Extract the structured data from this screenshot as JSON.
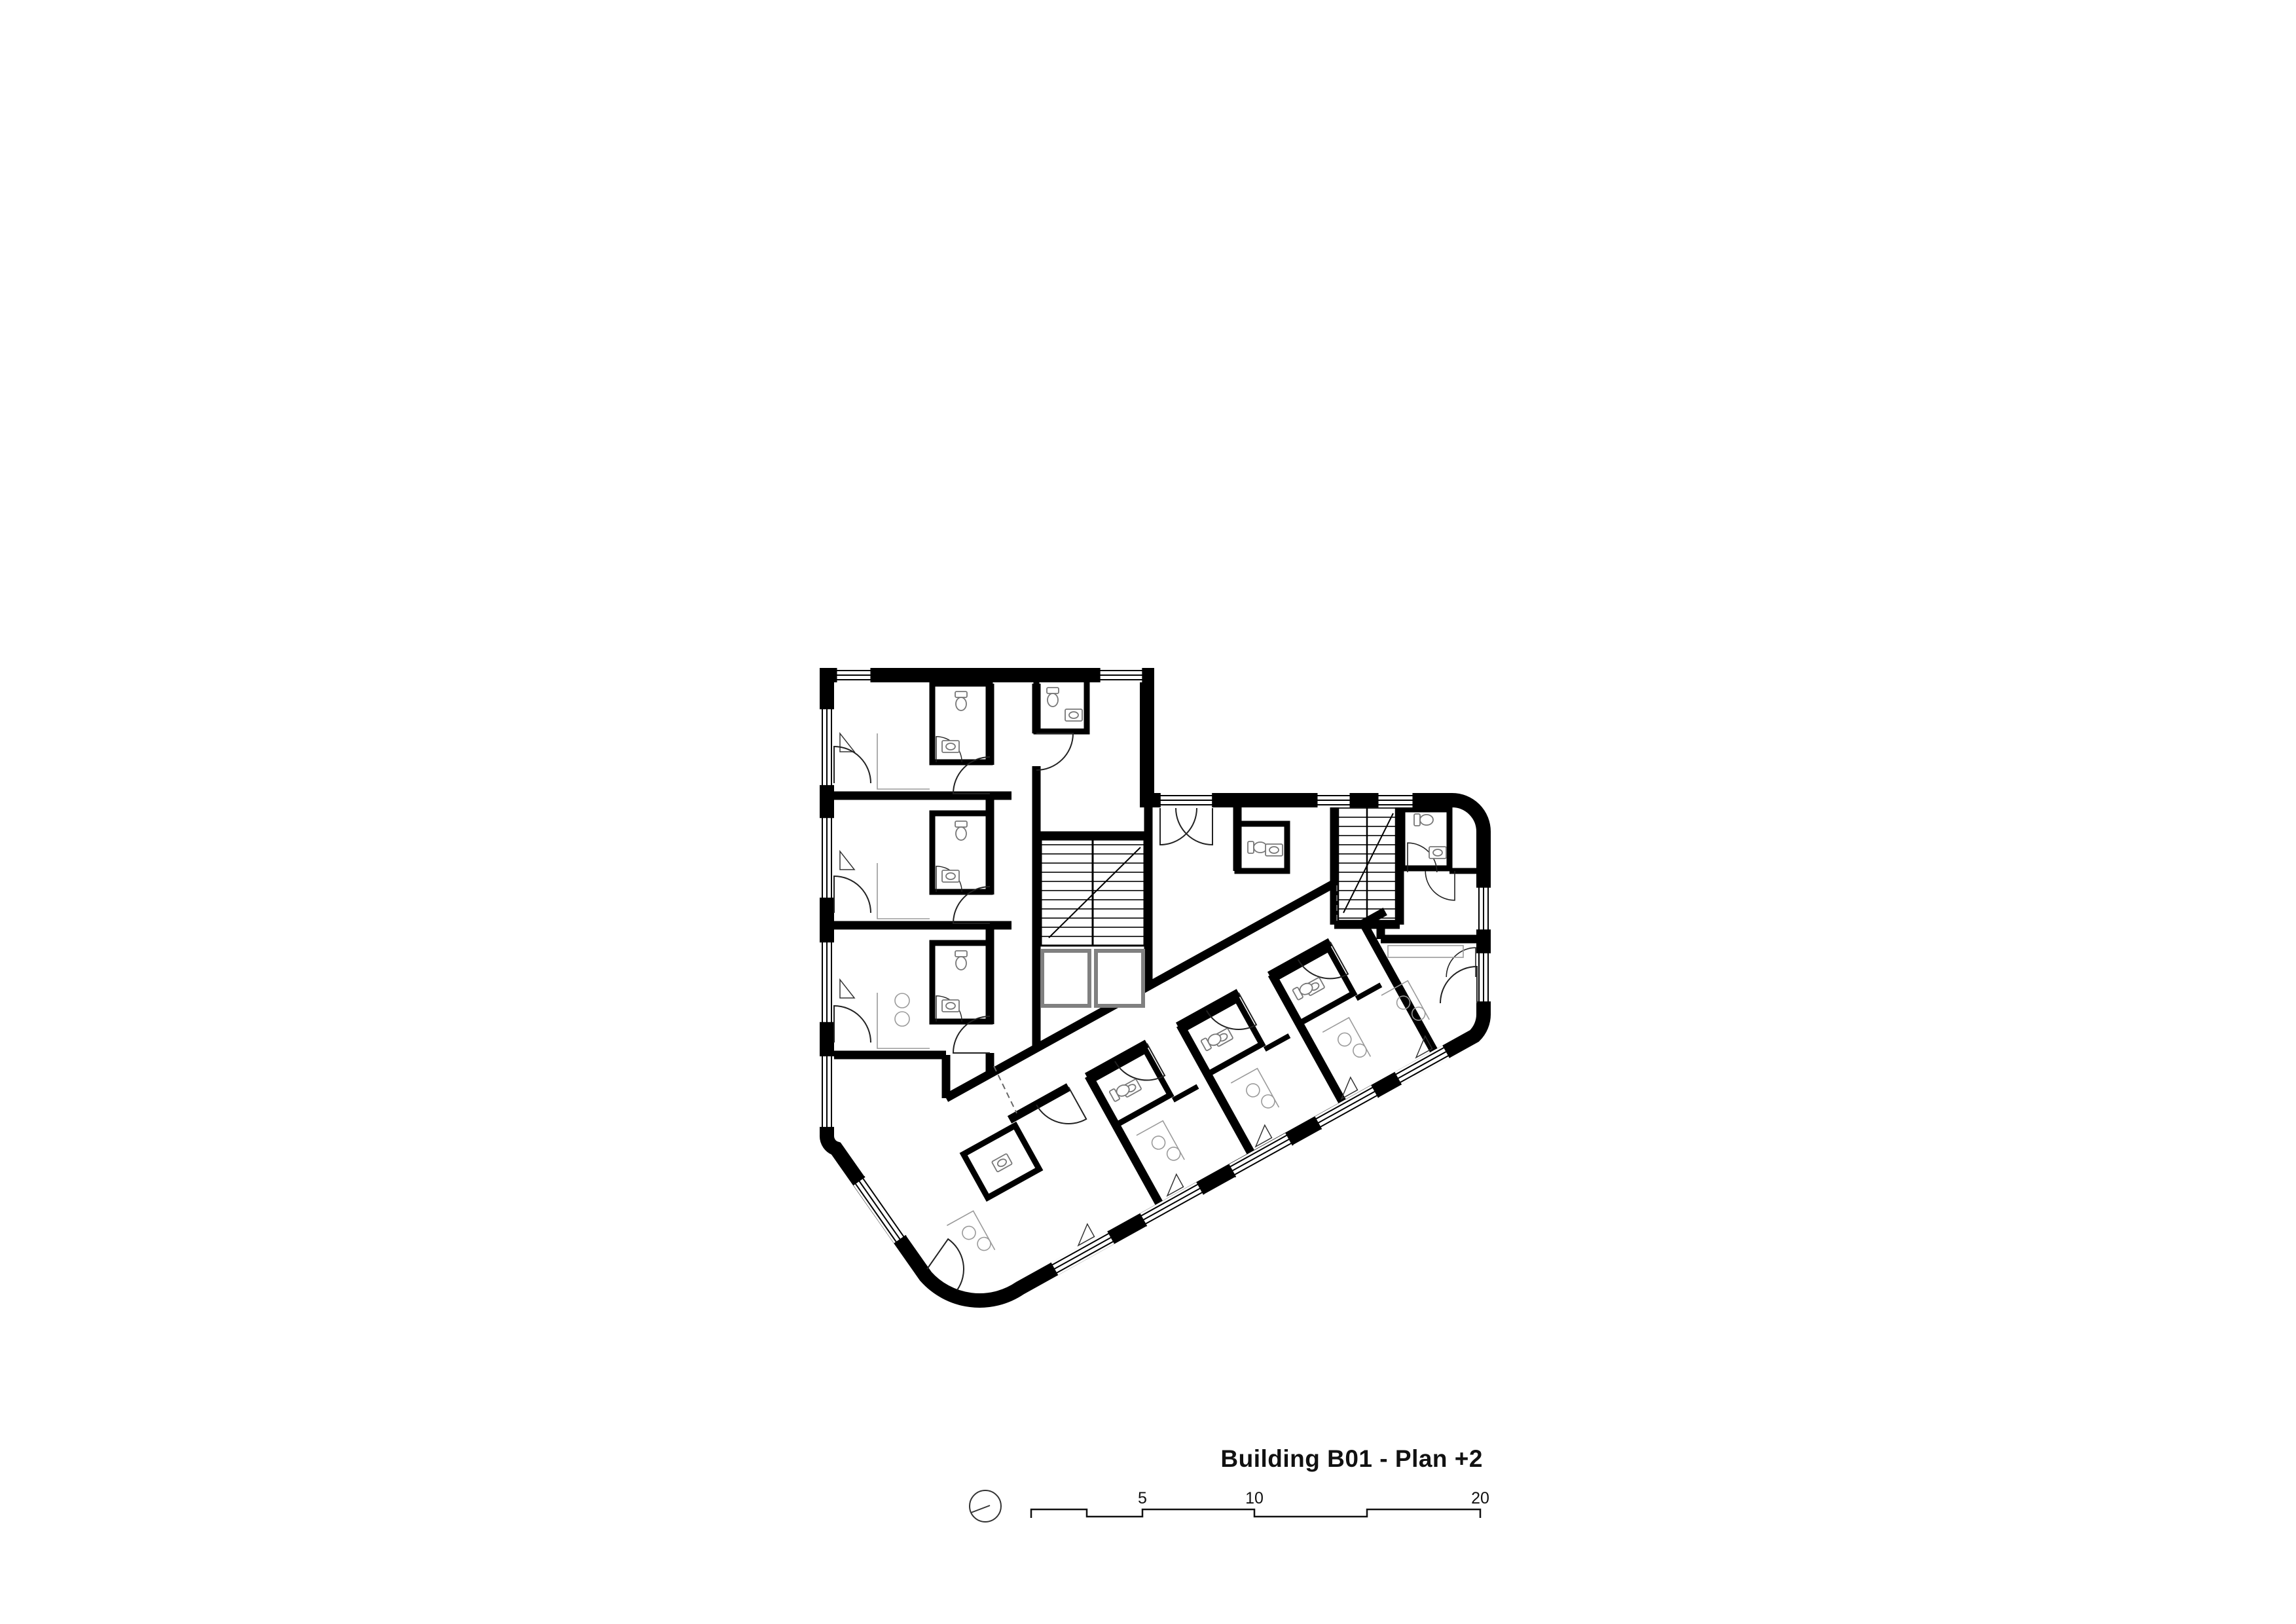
{
  "title_block": {
    "title": "Building B01 - Plan +2"
  },
  "scale_bar": {
    "unit_labels": {
      "five": "5",
      "ten": "10",
      "twenty": "20"
    }
  },
  "drawing": {
    "wall_color": "#000000",
    "line_color": "#1a1a1a",
    "furniture_color": "#9a9a9a",
    "shaft_color": "#808080",
    "dash_color": "#666666",
    "background": "#ffffff",
    "icons": {
      "north_indicator": "circle-with-needle"
    },
    "elements": {
      "stairwells": 2,
      "elevator_shafts": 2,
      "scale_max_meters": "20"
    }
  }
}
